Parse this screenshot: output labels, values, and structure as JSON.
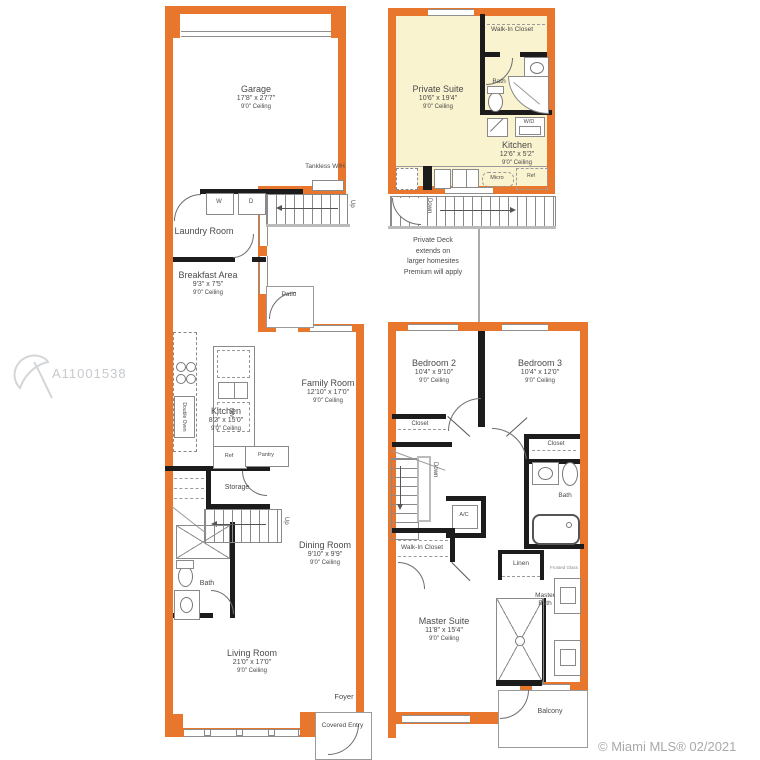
{
  "watermark": {
    "id": "A11001538"
  },
  "footer": {
    "copyright": "© Miami MLS® 02/2021"
  },
  "colors": {
    "wall_orange": "#e8762c",
    "suite_yellow": "#faf3cf",
    "wall_black": "#1c1c1c",
    "outline_gray": "#9a9a9a",
    "text_gray": "#4a4a4a"
  },
  "f1": {
    "garage": {
      "name": "Garage",
      "dims": "17'8\" x 27'7\"",
      "ceil": "9'0\" Ceiling"
    },
    "laundry": {
      "name": "Laundry Room"
    },
    "tankless": "Tankless W/H",
    "breakfast": {
      "name": "Breakfast Area",
      "dims": "9'3\" x 7'5\"",
      "ceil": "9'0\" Ceiling"
    },
    "patio": "Patio",
    "family": {
      "name": "Family Room",
      "dims": "12'10\" x 17'0\"",
      "ceil": "9'0\" Ceiling"
    },
    "kitchen": {
      "name": "Kitchen",
      "dims": "8'2\" x 15'0\"",
      "ceil": "9'0\" Ceiling"
    },
    "storage": "Storage",
    "dining": {
      "name": "Dining Room",
      "dims": "9'10\" x 9'9\"",
      "ceil": "9'0\" Ceiling"
    },
    "bath": "Bath",
    "living": {
      "name": "Living Room",
      "dims": "21'0\" x 17'0\"",
      "ceil": "9'0\" Ceiling"
    },
    "foyer": "Foyer",
    "covered_entry": "Covered Entry",
    "up": "Up",
    "washer": "W",
    "dryer": "D",
    "ref": "Ref",
    "pantry": "Pantry",
    "dw": "DW",
    "double_oven": "Double Oven"
  },
  "f2": {
    "private_suite": {
      "name": "Private Suite",
      "dims": "10'6\" x 19'4\"",
      "ceil": "9'0\" Ceiling"
    },
    "walkin": "Walk-In Closet",
    "bath": "Bath",
    "kitchen": {
      "name": "Kitchen",
      "dims": "12'6\" x 5'2\"",
      "ceil": "9'0\" Ceiling"
    },
    "ac": "A/C",
    "wd": "W/D",
    "micro": "Micro",
    "ref": "Ref",
    "down": "Down",
    "deck_note": [
      "Private Deck",
      "extends on",
      "larger homesites",
      "Premium will apply"
    ],
    "bedroom2": {
      "name": "Bedroom 2",
      "dims": "10'4\" x 9'10\"",
      "ceil": "9'0\" Ceiling"
    },
    "bedroom3": {
      "name": "Bedroom 3",
      "dims": "10'4\" x 12'0\"",
      "ceil": "9'0\" Ceiling"
    },
    "closet": "Closet",
    "walkin_master": "Walk-In Closet",
    "linen": "Linen",
    "master_bath": "Master Bath",
    "frosted": "Frosted Glass",
    "master_suite": {
      "name": "Master Suite",
      "dims": "11'8\" x 15'4\"",
      "ceil": "9'0\" Ceiling"
    },
    "balcony": "Balcony"
  }
}
